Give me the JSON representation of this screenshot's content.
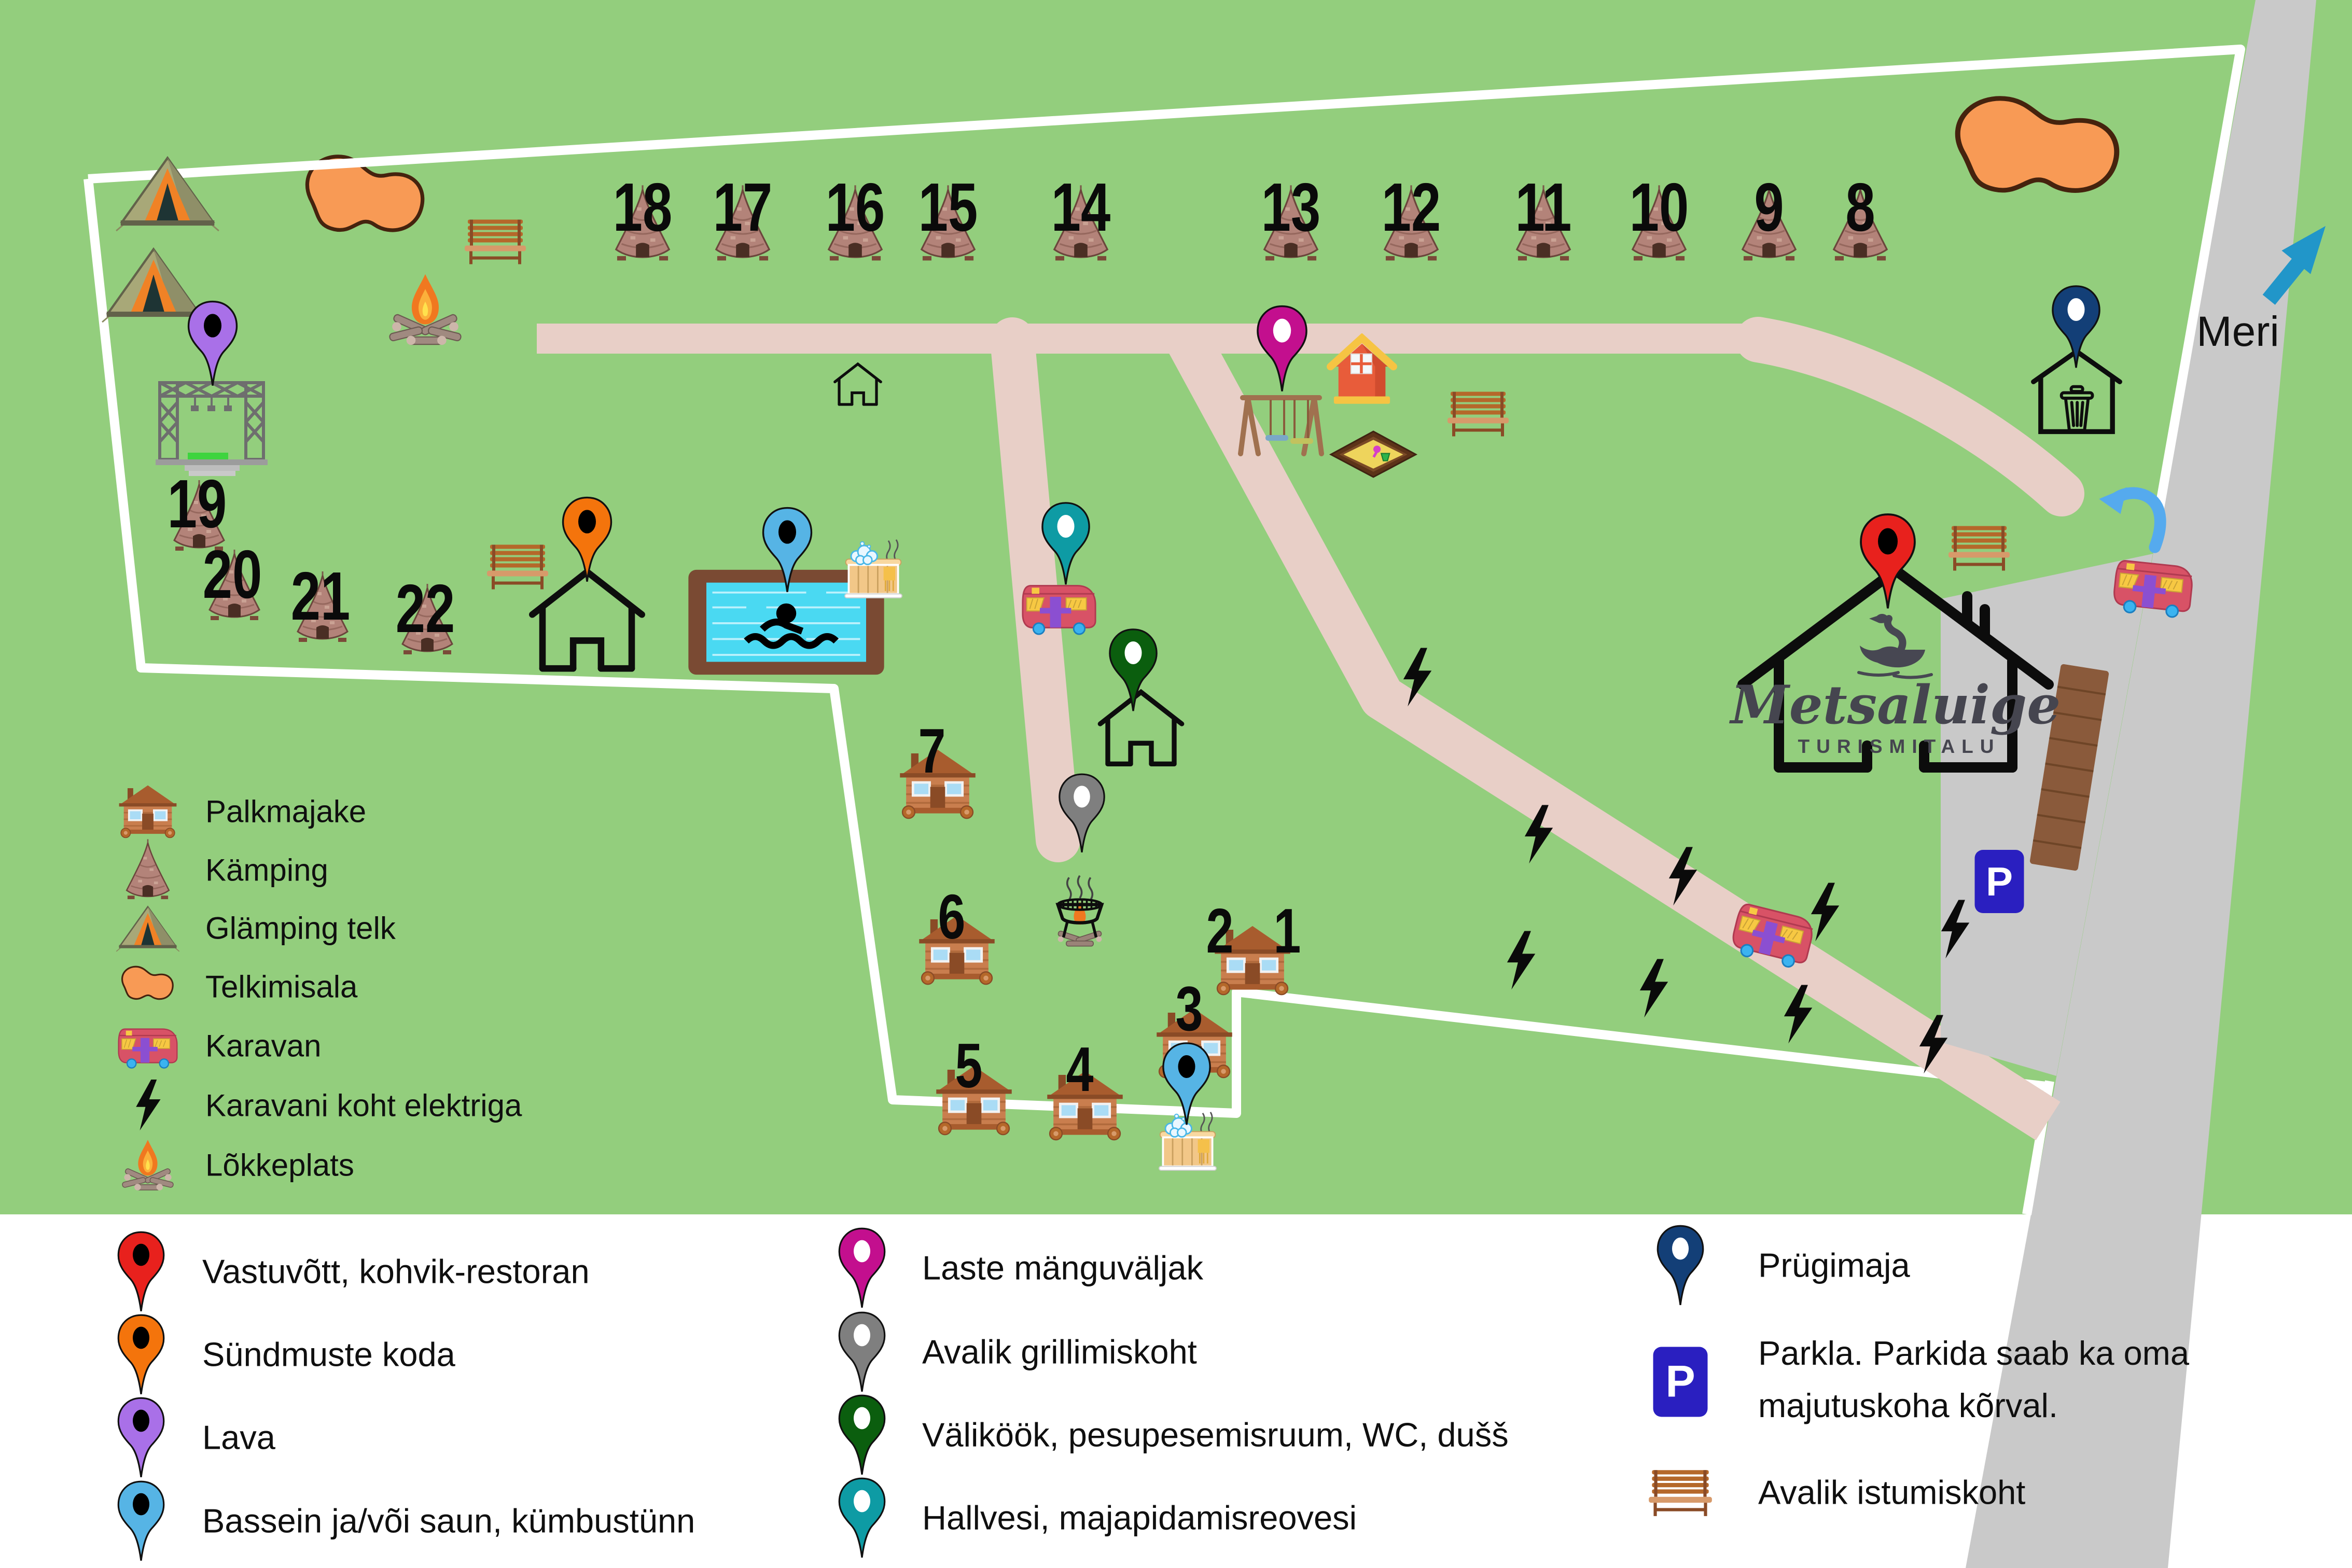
{
  "map": {
    "sea_label": "Meri",
    "logo_title": "Metsaluige",
    "logo_subtitle": "TURISMITALU",
    "parking_sign": "P",
    "sites": [
      "1",
      "2",
      "3",
      "4",
      "5",
      "6",
      "7",
      "8",
      "9",
      "10",
      "11",
      "12",
      "13",
      "14",
      "15",
      "16",
      "17",
      "18",
      "19",
      "20",
      "21",
      "22"
    ]
  },
  "map_legend": {
    "items": [
      {
        "icon": "log-cabin-icon",
        "label": "Palkmajake"
      },
      {
        "icon": "teepee-icon",
        "label": "Kämping"
      },
      {
        "icon": "glamping-tent-icon",
        "label": "Glämping telk"
      },
      {
        "icon": "tent-area-icon",
        "label": "Telkimisala"
      },
      {
        "icon": "caravan-icon",
        "label": "Karavan"
      },
      {
        "icon": "lightning-icon",
        "label": "Karavani koht elektriga"
      },
      {
        "icon": "campfire-icon",
        "label": "Lõkkeplats"
      }
    ]
  },
  "legend": {
    "column1": [
      {
        "icon": "pin",
        "color": "#e8211d",
        "hole": "#000000",
        "label": "Vastuvõtt, kohvik-restoran"
      },
      {
        "icon": "pin",
        "color": "#f4740c",
        "hole": "#000000",
        "label": "Sündmuste koda"
      },
      {
        "icon": "pin",
        "color": "#a970e8",
        "hole": "#000000",
        "label": "Lava"
      },
      {
        "icon": "pin",
        "color": "#56b4e5",
        "hole": "#000000",
        "label": "Bassein ja/või saun, kümbustünn"
      }
    ],
    "column2": [
      {
        "icon": "pin",
        "color": "#c30f8e",
        "hole": "#ffffff",
        "label": "Laste mänguväljak"
      },
      {
        "icon": "pin",
        "color": "#7f7f7f",
        "hole": "#ffffff",
        "label": "Avalik grillimiskoht"
      },
      {
        "icon": "pin",
        "color": "#0b5e0e",
        "hole": "#ffffff",
        "label": "Väliköök, pesupesemisruum, WC, dušš"
      },
      {
        "icon": "pin",
        "color": "#0e9ba4",
        "hole": "#ffffff",
        "label": "Hallvesi, majapidamisreovesi"
      }
    ],
    "column3": [
      {
        "icon": "pin",
        "color": "#133f77",
        "hole": "#ffffff",
        "label": "Prügimaja"
      },
      {
        "icon": "parking-sign",
        "label": "Parkla. Parkida saab ka oma majutuskoha kõrval."
      },
      {
        "icon": "bench-icon",
        "label": "Avalik istumiskoht"
      }
    ]
  },
  "colors": {
    "ground": "#93ce7d",
    "path": "#e8cfc7",
    "road": "#c9c9c9",
    "border": "#ffffff",
    "tent_area": "#f89a55",
    "parking_sign_bg": "#2a1fc0"
  }
}
